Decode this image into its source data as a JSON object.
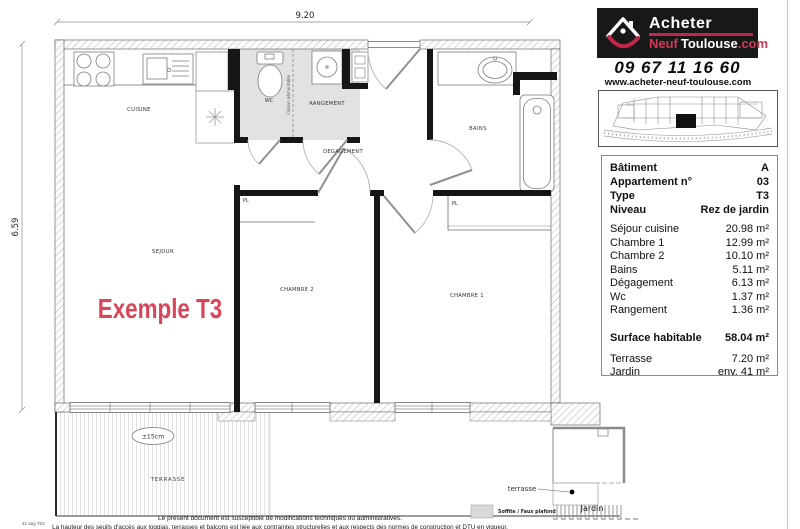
{
  "branding": {
    "logo": {
      "line1": "Acheter",
      "neuf": "Neuf",
      "toulouse": "Toulouse",
      "com": ".com"
    },
    "phone": "09 67 11 16 60",
    "website": "www.acheter-neuf-toulouse.com",
    "accent_color": "#c2274b",
    "logo_background": "#181818"
  },
  "info_panel": {
    "header_rows": [
      {
        "label": "Bâtiment",
        "value": "A"
      },
      {
        "label": "Appartement n°",
        "value": "03"
      },
      {
        "label": "Type",
        "value": "T3"
      },
      {
        "label": "Niveau",
        "value": "Rez de jardin"
      }
    ],
    "room_rows": [
      {
        "label": "Séjour cuisine",
        "value": "20.98 m²"
      },
      {
        "label": "Chambre 1",
        "value": "12.99 m²"
      },
      {
        "label": "Chambre 2",
        "value": "10.10 m²"
      },
      {
        "label": "Bains",
        "value": "5.11 m²"
      },
      {
        "label": "Dégagement",
        "value": "6.13 m²"
      },
      {
        "label": "Wc",
        "value": "1.37 m²"
      },
      {
        "label": "Rangement",
        "value": "1.36 m²"
      }
    ],
    "total_row": {
      "label": "Surface habitable",
      "value": "58.04 m²"
    },
    "extra_rows": [
      {
        "label": "Terrasse",
        "value": "7.20 m²"
      },
      {
        "label": "Jardin",
        "value": "env. 41 m²"
      }
    ]
  },
  "plan": {
    "title": "Exemple T3",
    "title_color": "#d9465a",
    "dim_width": "9.20",
    "dim_height": "6.59",
    "labels": {
      "cuisine": "CUISINE",
      "wc": "WC",
      "rangement": "RANGEMENT",
      "degagement": "DEGAGEMENT",
      "sejour": "SEJOUR",
      "chambre2": "CHAMBRE 2",
      "chambre1": "CHAMBRE 1",
      "bains": "BAINS",
      "pl1": "PL",
      "pl2": "PL",
      "cloison": "Cloison démontable",
      "seuil": "±15cm",
      "terrasse": "TERRASSE"
    }
  },
  "inset": {
    "terrasse": "terrasse",
    "jardin": "Jardin"
  },
  "legend": {
    "soffite": "Soffite / Faux plafond"
  },
  "footer": {
    "ref": "21 aug T03",
    "line1": "Le présent document est susceptible de modifications techniques ou administratives.",
    "line2": "La hauteur des seuils d'accès aux loggias, terrasses et balcons est liée aux contraintes structurelles et aux respects des normes de construction et DTU en vigueur."
  }
}
